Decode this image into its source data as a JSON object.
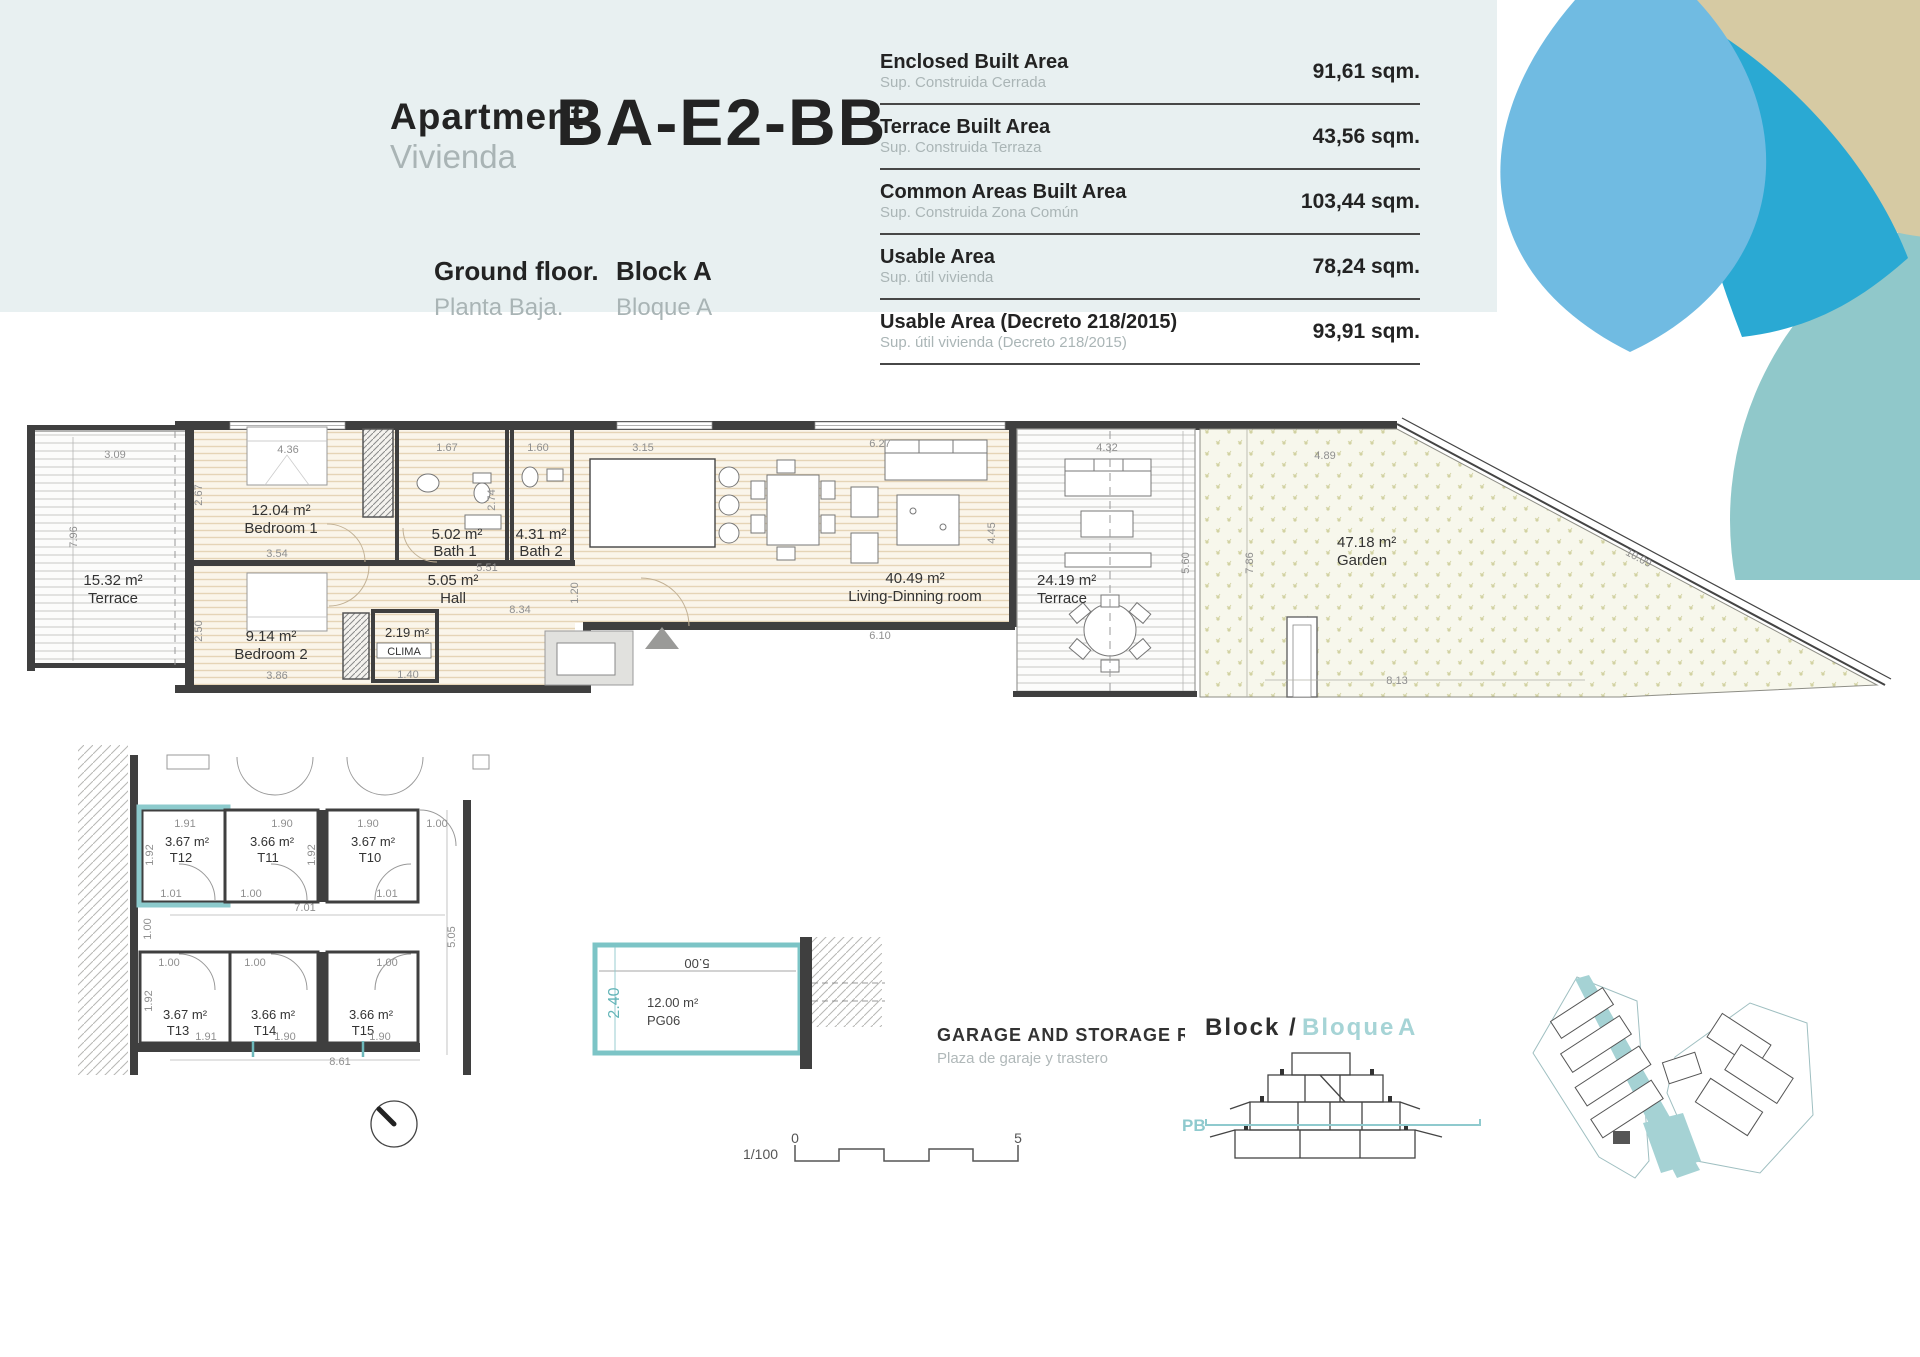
{
  "header": {
    "apartment_en": "Apartment",
    "apartment_es": "Vivienda",
    "unit_code": "BA-E2-BB",
    "floor_en": "Ground floor.",
    "floor_es": "Planta Baja.",
    "block_en": "Block A",
    "block_es": "Bloque A"
  },
  "area_table": {
    "rows": [
      {
        "label_en": "Enclosed Built Area",
        "label_es": "Sup. Construida Cerrada",
        "value": "91,61 sqm."
      },
      {
        "label_en": "Terrace Built Area",
        "label_es": "Sup. Construida Terraza",
        "value": "43,56 sqm."
      },
      {
        "label_en": "Common Areas Built Area",
        "label_es": "Sup. Construida Zona Común",
        "value": "103,44 sqm."
      },
      {
        "label_en": "Usable Area",
        "label_es": "Sup. útil vivienda",
        "value": "78,24 sqm."
      },
      {
        "label_en": "Usable Area (Decreto 218/2015)",
        "label_es": "Sup. útil vivienda (Decreto 218/2015)",
        "value": "93,91 sqm."
      }
    ]
  },
  "plan": {
    "rooms": [
      {
        "area": "15.32 m²",
        "name": "Terrace"
      },
      {
        "area": "12.04 m²",
        "name": "Bedroom 1"
      },
      {
        "area": "5.02 m²",
        "name": "Bath 1"
      },
      {
        "area": "4.31 m²",
        "name": "Bath 2"
      },
      {
        "area": "5.05 m²",
        "name": "Hall"
      },
      {
        "area": "9.14 m²",
        "name": "Bedroom 2"
      },
      {
        "area": "2.19 m²",
        "name": "CLIMA"
      },
      {
        "area": "40.49 m²",
        "name": "Living-Dinning room"
      },
      {
        "area": "24.19 m²",
        "name": "Terrace"
      },
      {
        "area": "47.18 m²",
        "name": "Garden"
      }
    ],
    "dims": {
      "terrace_w": "3.09",
      "terrace_h": "7.96",
      "bed1_w": "4.36",
      "bed1_side": "2.67",
      "bed1_b": "3.54",
      "bath1_w": "1.67",
      "bath1_side": "2.74",
      "bath2_w": "1.60",
      "hall_a": "5.51",
      "hall_b": "8.34",
      "hall_v": "1.20",
      "bed2_side": "2.50",
      "bed2_b": "3.86",
      "clima_b": "1.40",
      "kitchen_w": "3.15",
      "living_w": "6.27",
      "living_b": "6.10",
      "living_side": "4.45",
      "terrace2_w": "4.32",
      "terrace2_side": "5.60",
      "garden_w": "4.89",
      "garden_side": "7.86",
      "garden_b": "8.13",
      "garden_diag": "10.09"
    }
  },
  "storage": {
    "rooms": [
      {
        "area": "3.67 m²",
        "code": "T12"
      },
      {
        "area": "3.66 m²",
        "code": "T11"
      },
      {
        "area": "3.67 m²",
        "code": "T10"
      },
      {
        "area": "3.67 m²",
        "code": "T13"
      },
      {
        "area": "3.66 m²",
        "code": "T14"
      },
      {
        "area": "3.66 m²",
        "code": "T15"
      }
    ],
    "dims": {
      "t12_w": "1.91",
      "t12_h": "1.92",
      "t12_b": "1.01",
      "t11_w": "1.90",
      "t11_b": "1.00",
      "row1_v": "1.92",
      "t10_w": "1.90",
      "t10_b": "1.01",
      "t10_door": "1.00",
      "row_w": "7.01",
      "gap": "1.00",
      "right_h": "5.05",
      "t13_t": "1.00",
      "t13_h": "1.92",
      "t13_b": "1.91",
      "t14_t": "1.00",
      "t14_b": "1.90",
      "t15_t": "1.00",
      "t15_b": "1.90",
      "total_b": "8.61"
    }
  },
  "garage": {
    "area": "12.00 m²",
    "code": "PG06",
    "width": "5.00",
    "depth": "2.40",
    "title_en": "GARAGE AND STORAGE ROOM",
    "title_es": "Plaza de garaje y trastero"
  },
  "scalebar": {
    "ratio": "1/100",
    "zero": "0",
    "five": "5"
  },
  "block_section": {
    "title_en": "Block /",
    "bloque": "Bloque",
    "letter": "A",
    "level": "PB"
  },
  "colors": {
    "band": "#e8f0f1",
    "accent_teal": "#7cc4c6",
    "pale_teal_text": "#a6d4d6",
    "deco_lightblue": "#70bbe2",
    "deco_cyan": "#2aa9d3",
    "deco_tan": "#d6caa3",
    "deco_teal": "#90c8ca",
    "wall": "#3f3f3f"
  }
}
